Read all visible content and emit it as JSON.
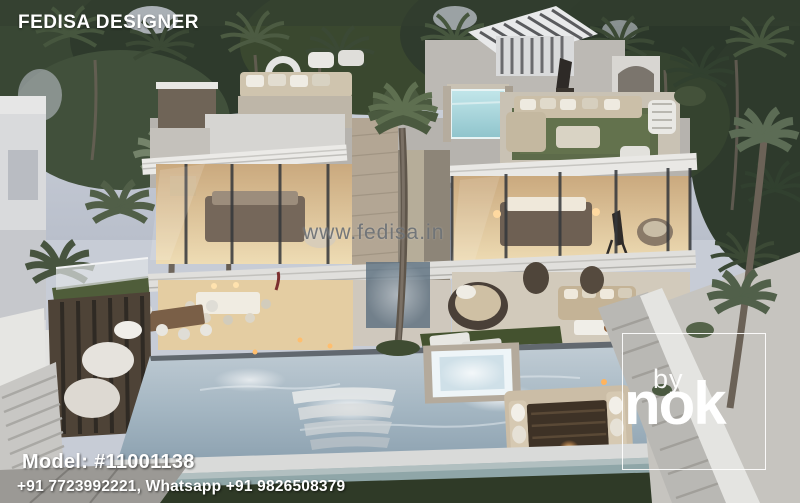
{
  "meta": {
    "content_type": "architectural-3d-render",
    "subject": "Aerial dusk view of a modern two-storey luxury villa with glass facades, rooftop terraces, glass plunge pool and large infinity swimming pool surrounded by palm trees"
  },
  "overlays": {
    "brand": "FEDISA DESIGNER",
    "watermark": "www.fedisa.in",
    "model": "Model: #11001138",
    "contact": "+91 7723992221, Whatsapp +91 9826508379",
    "logo": {
      "line1": "by",
      "line2": "nok"
    }
  },
  "palette": {
    "sky": "#c7ccd6",
    "foliage_dark": "#2e3a2c",
    "foliage_mid": "#3f4d3a",
    "foliage_light": "#74836a",
    "villa_white": "#e2e1de",
    "concrete": "#b9b6b0",
    "stone_tan": "#b3a694",
    "glass_dark": "#3a3f45",
    "warm_interior": "#e6cfa4",
    "rooftop_pool_aqua": "#9fd2d8",
    "main_pool": "#9fb3c0",
    "grass": "#4d5c3a",
    "wood_dark": "#4e4337",
    "overlay_text": "#ffffff",
    "watermark_gray": "#6e7276"
  }
}
